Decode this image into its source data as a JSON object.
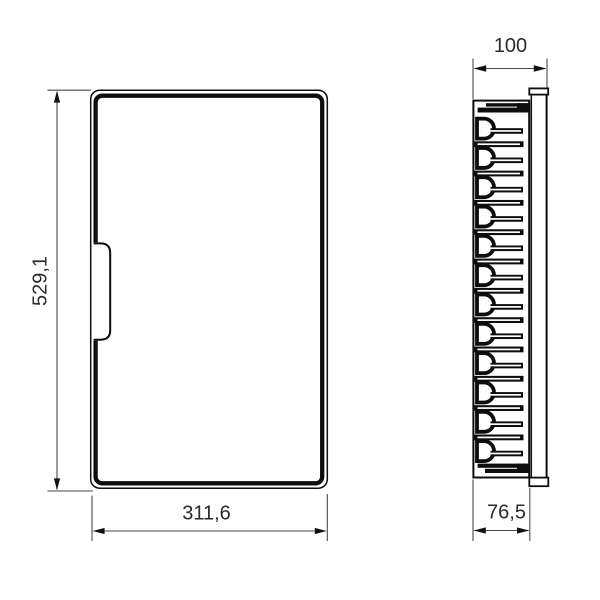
{
  "drawing": {
    "type": "technical-drawing",
    "background_color": "#ffffff",
    "line_color": "#0d0d0d",
    "dimension_line_color": "#4a4a4a",
    "dimensions": {
      "height": "529,1",
      "width": "311,6",
      "depth_total": "100",
      "depth_body": "76,5"
    },
    "views": {
      "front": {
        "description": "front view of enclosure door with handle"
      },
      "side": {
        "description": "side profile with fin/hinge stack and wall-mount plate",
        "fin_count": 12
      }
    }
  }
}
